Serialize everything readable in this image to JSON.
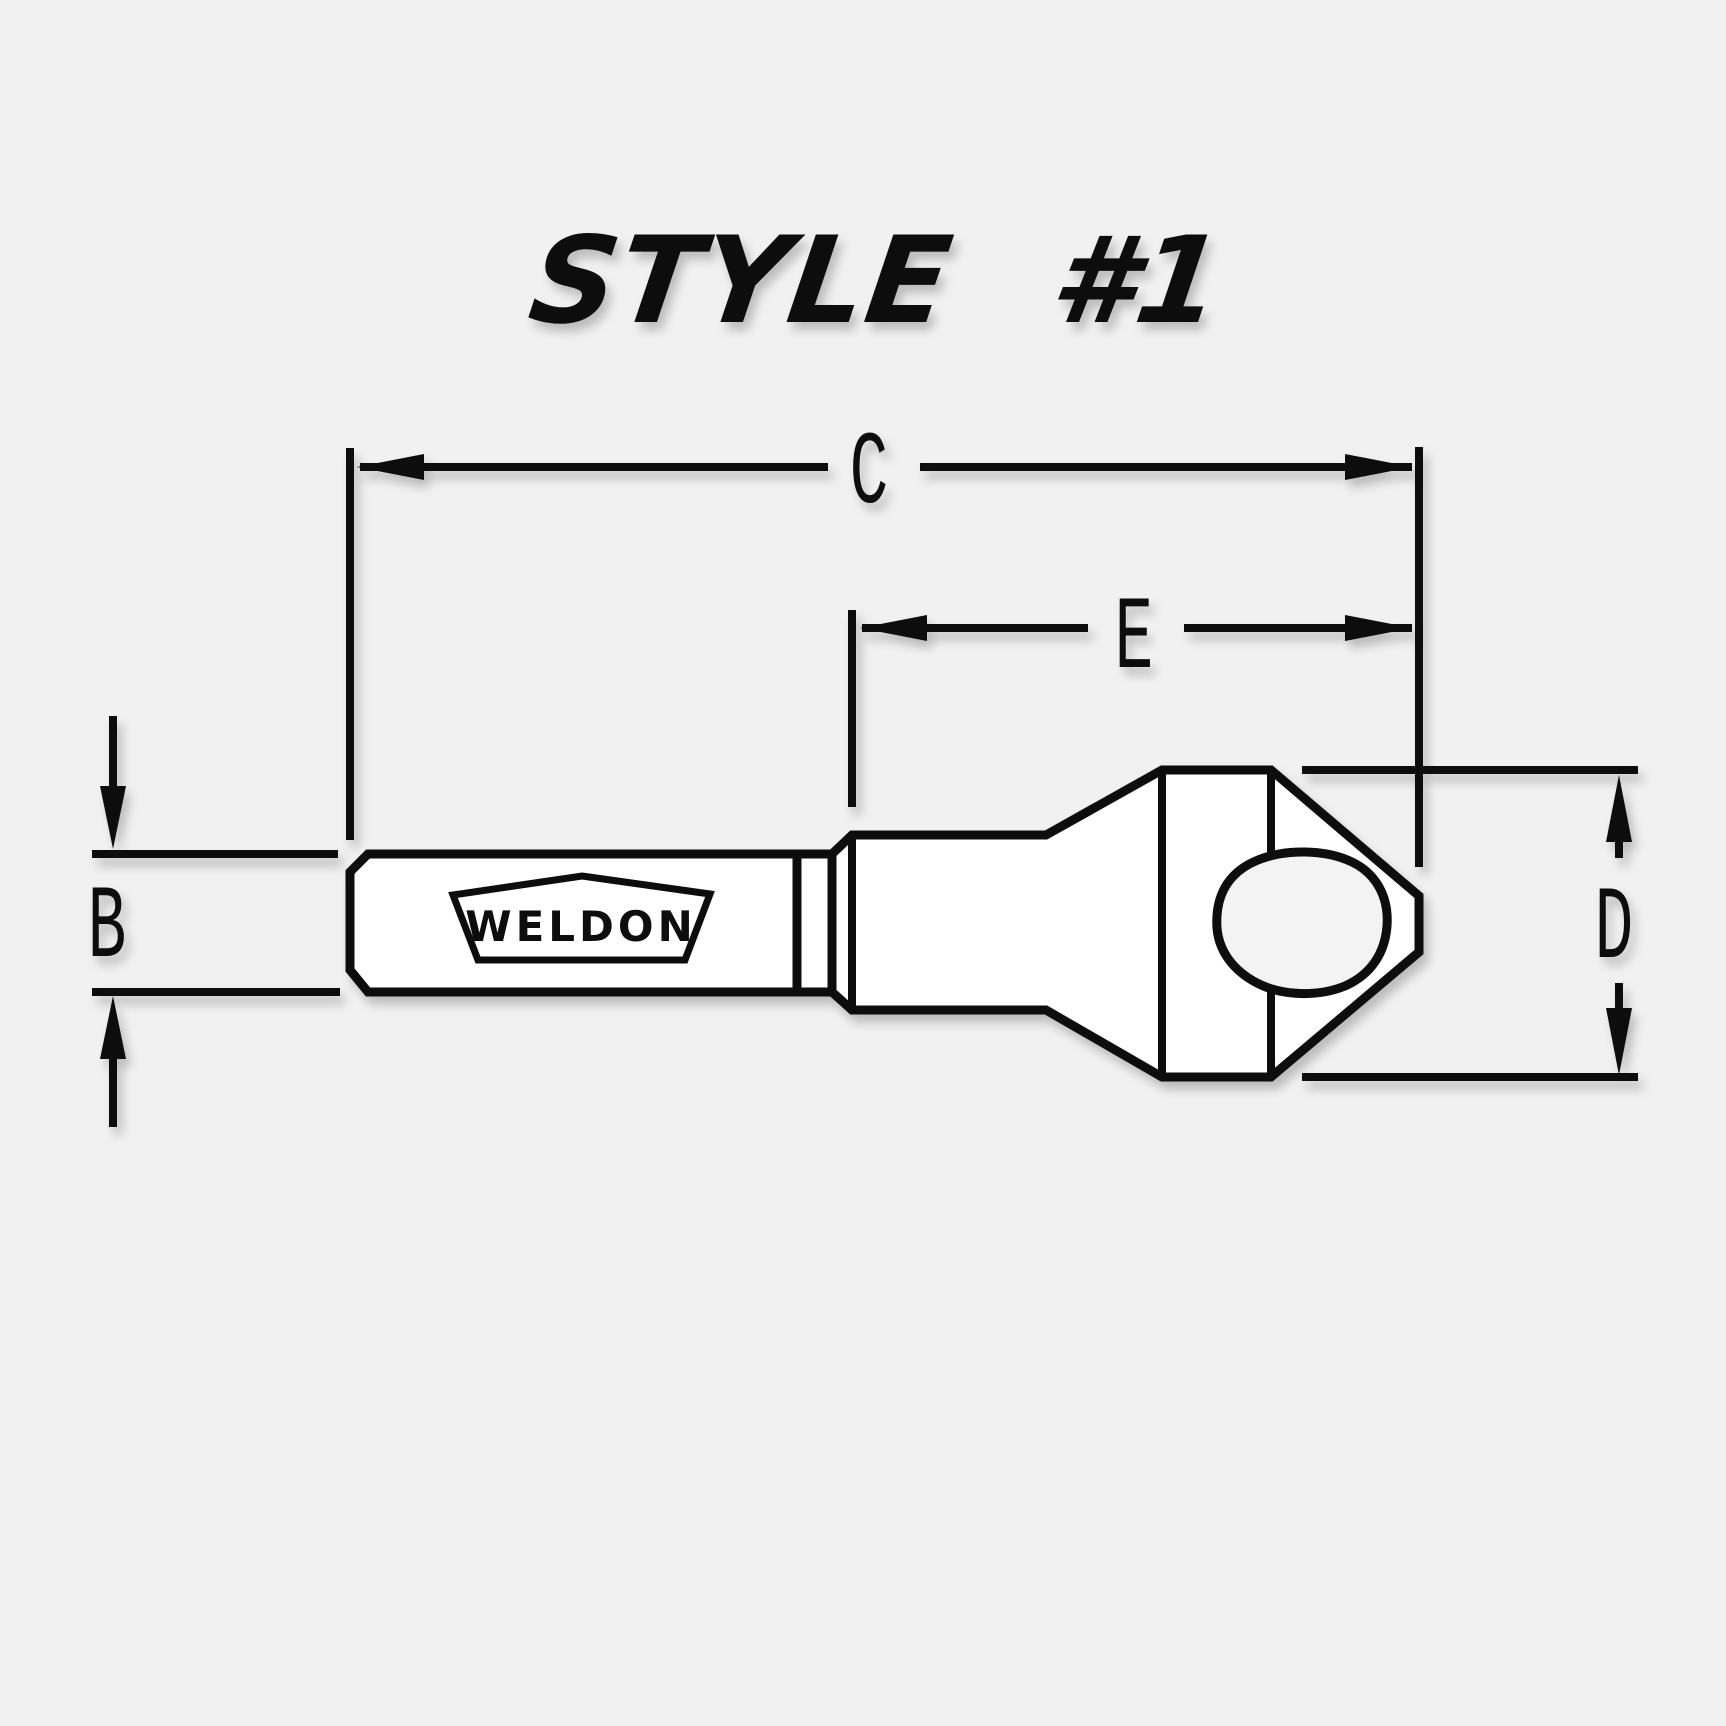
{
  "title": "STYLE #1",
  "drawing": {
    "logo_text": "WELDON",
    "labels": {
      "b": "B",
      "c": "C",
      "d": "D",
      "e": "E"
    }
  },
  "colors": {
    "background": "#f1f1f1",
    "line": "#0b0b0b",
    "tool_fill": "#ffffff",
    "hole_fill": "#f3f3f3"
  }
}
